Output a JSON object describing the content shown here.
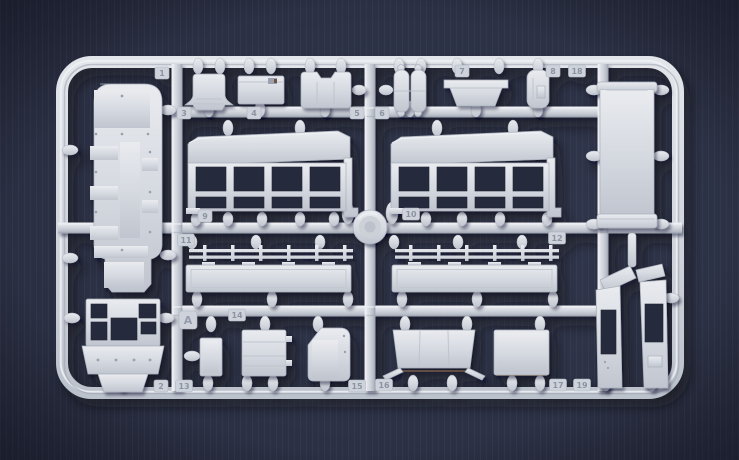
{
  "scene": {
    "type": "photograph",
    "subject": "injection-molded plastic model kit sprue with numbered parts",
    "sprue_letter": "A",
    "colors": {
      "background": "#2b3044",
      "background_corner": "#22263a",
      "plastic_light": "#eef0f4",
      "plastic_mid": "#d5d9e0",
      "plastic_shadow": "#a6adb9",
      "window_hole": "#262b3d"
    }
  },
  "tags": [
    {
      "label": "1"
    },
    {
      "label": "3"
    },
    {
      "label": "4"
    },
    {
      "label": "5"
    },
    {
      "label": "6"
    },
    {
      "label": "7"
    },
    {
      "label": "8"
    },
    {
      "label": "18"
    },
    {
      "label": "9"
    },
    {
      "label": "10"
    },
    {
      "label": "11"
    },
    {
      "label": "12"
    },
    {
      "label": "A"
    },
    {
      "label": "14"
    },
    {
      "label": "2"
    },
    {
      "label": "13"
    },
    {
      "label": "15"
    },
    {
      "label": "16"
    },
    {
      "label": "17"
    },
    {
      "label": "19"
    }
  ]
}
